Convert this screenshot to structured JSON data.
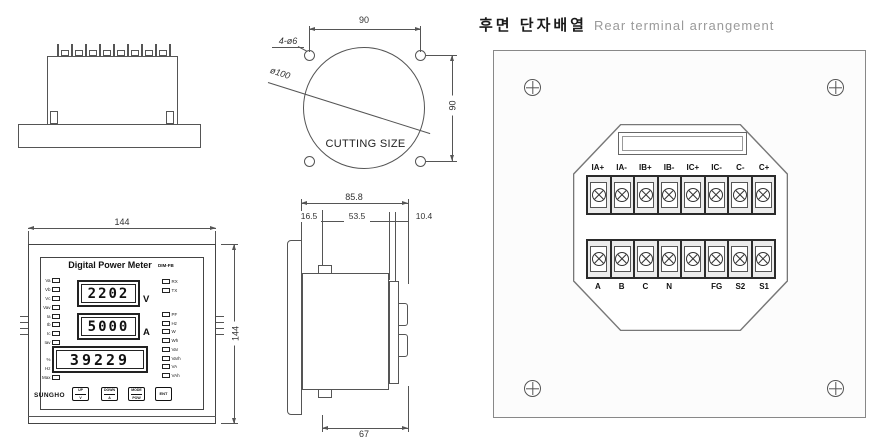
{
  "header": {
    "title_ko": "후면 단자배열",
    "title_en": "Rear terminal arrangement"
  },
  "cutting": {
    "caption": "CUTTING SIZE",
    "dim_width": "90",
    "dim_height": "90",
    "holes": "4-ø6",
    "diameter": "ø100"
  },
  "front": {
    "dim_width": "144",
    "dim_height": "144",
    "title": "Digital Power Meter",
    "model": "DIM-FB",
    "brand": "SUNGHO",
    "display_v": "2202",
    "unit_v": "V",
    "display_a": "5000",
    "unit_a": "A",
    "display_e": "39229",
    "leds_left": [
      "Va",
      "Vb",
      "Vc",
      "Vav",
      "Ia",
      "Ib",
      "Ic",
      "Iav"
    ],
    "leds_left2": [
      "%",
      "Hz",
      "Max"
    ],
    "leds_right_top": [
      "RX",
      "TX"
    ],
    "leds_right": [
      "PF",
      "Hz",
      "W",
      "Wh",
      "Var",
      "Varh",
      "VA",
      "VAh"
    ],
    "buttons": [
      {
        "top": "UP",
        "bottom": "V"
      },
      {
        "top": "DOWN",
        "bottom": "A"
      },
      {
        "top": "MODE",
        "bottom": "POW"
      }
    ],
    "button_ent": "ENT"
  },
  "side": {
    "dim_total": "85.8",
    "dim_bezel": "16.5",
    "dim_body": "53.5",
    "dim_rear": "10.4",
    "dim_bottom": "67"
  },
  "rear": {
    "top_terminals": [
      "IA+",
      "IA-",
      "IB+",
      "IB-",
      "IC+",
      "IC-",
      "C-",
      "C+"
    ],
    "bottom_terminals": [
      "A",
      "B",
      "C",
      "N",
      "",
      "FG",
      "S2",
      "S1"
    ]
  }
}
